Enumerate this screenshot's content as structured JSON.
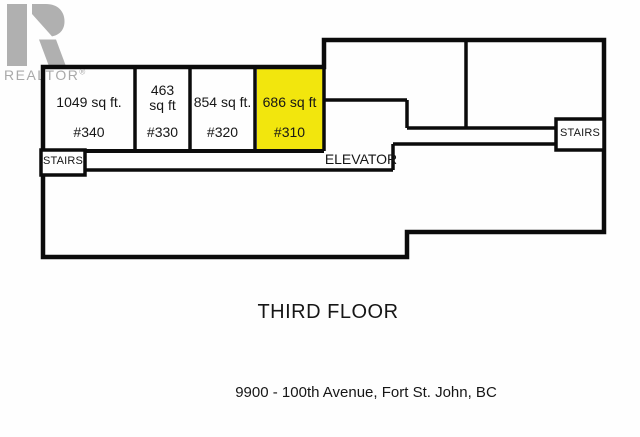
{
  "logo": {
    "text": "REALTOR",
    "registered": "®",
    "color": "#a9a9a9"
  },
  "floor_plan": {
    "wall_color": "#0b0b0b",
    "highlight_color": "#f2e60d",
    "rooms": [
      {
        "area": "1049 sq ft.",
        "unit": "#340",
        "highlighted": false
      },
      {
        "area": "463 sq ft",
        "unit": "#330",
        "highlighted": false
      },
      {
        "area": "854 sq ft.",
        "unit": "#320",
        "highlighted": false
      },
      {
        "area": "686 sq ft",
        "unit": "#310",
        "highlighted": true
      }
    ],
    "labels": {
      "elevator": "ELEVATOR",
      "stairs_left": "STAIRS",
      "stairs_right": "STAIRS"
    }
  },
  "title": "THIRD FLOOR",
  "address": "9900 - 100th Avenue, Fort St. John, BC"
}
